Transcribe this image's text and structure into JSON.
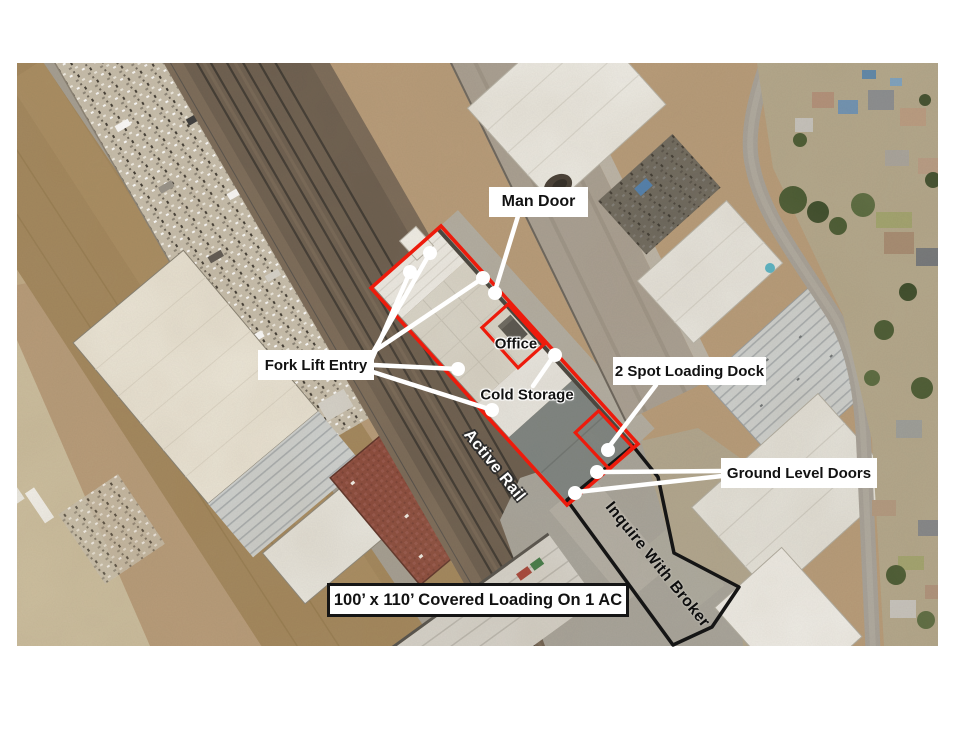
{
  "image": {
    "kind": "aerial-site-plan"
  },
  "callouts": {
    "man_door": "Man Door",
    "fork_lift_entry": "Fork Lift Entry",
    "office": "Office",
    "cold_storage": "Cold Storage",
    "loading_dock": "2 Spot Loading Dock",
    "ground_level_doors": "Ground Level Doors",
    "active_rail": "Active Rail",
    "inquire_with_broker": "Inquire With Broker",
    "covered_loading": "100’ x 110’ Covered Loading On 1 AC"
  },
  "colors": {
    "highlight_red": "#ed1b0c",
    "parcel_outline_black": "#151515",
    "callout_white": "#ffffff",
    "label_text": "#121212"
  }
}
